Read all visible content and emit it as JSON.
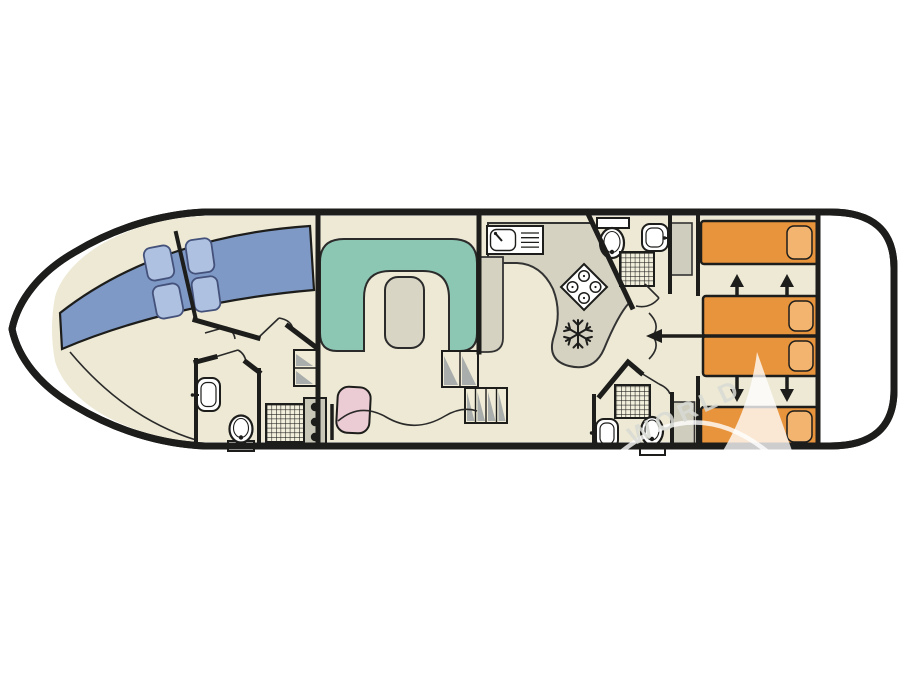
{
  "diagram": {
    "type": "houseboat-floor-plan",
    "watermark": {
      "text": "WORLD"
    },
    "colors": {
      "background": "#ffffff",
      "hull_outline": "#1d1d1b",
      "floor": "#EDE9D4",
      "bed_blue": "#7E99C6",
      "pillow_blue": "#AEC1E0",
      "sofa_green": "#8CC7B4",
      "table_grey": "#D8D5C5",
      "counter_grey": "#D5D2C2",
      "cabinet_grey": "#CFCDBD",
      "console_grey": "#C9C7B8",
      "seat_pink": "#EBCBD4",
      "bed_orange": "#E8943C",
      "pillow_orange": "#F2B46E",
      "steps_shade": "#A9ADAB",
      "steps_floor": "#EFEBD6",
      "fixture_white": "#FFFFFF",
      "watermark_grey": "#D9DBD5"
    },
    "fixtures": {
      "toilet-icon": "oval bowl with tank",
      "sink-icon": "rounded basin with tap",
      "shower-icon": "square grid tray",
      "stove-icon": "diamond hob with four burners",
      "freezer-icon": "snowflake",
      "helm-icon": "console with three gauges and lever",
      "steps-icon": "hatched treads",
      "bed-slide-arrow": "black arrow"
    }
  }
}
